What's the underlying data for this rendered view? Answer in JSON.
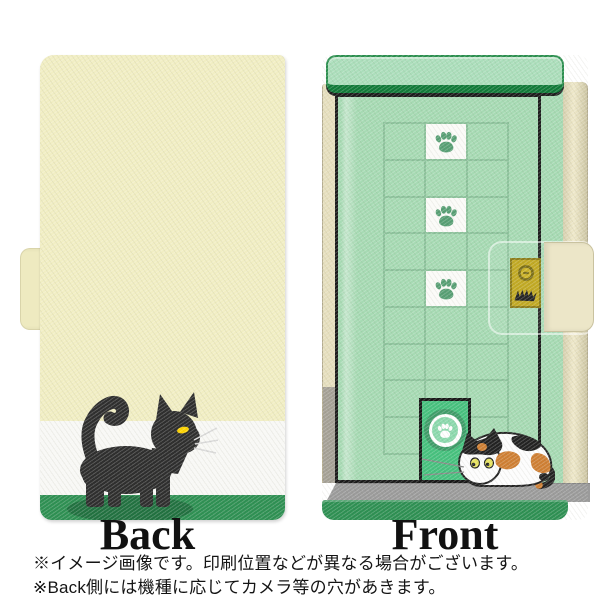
{
  "views": {
    "back": {
      "label": "Back"
    },
    "front": {
      "label": "Front"
    }
  },
  "notes": {
    "line1": "※イメージ画像です。印刷位置などが異なる場合がございます。",
    "line2": "※Back側には機種に応じてカメラ等の穴があきます。"
  },
  "palette": {
    "back_cover_cream": "#f1eec3",
    "band_white": "#f8f8f5",
    "grass_green": "#2e9053",
    "front_door_green": "#a6dab3",
    "lintel_green": "#abdebb",
    "cat_door_green": "#46c17e",
    "lock_plate_gold": "#bda313",
    "floor_gray": "#9b9b9b",
    "spine_beige": "#e9e2c1",
    "black_cat": "#2e2e2e",
    "calico_orange": "#cf7f33",
    "cat_eye_yellow": "#ffd400"
  },
  "icons": {
    "door_tiles": "paw-print-icon",
    "cat_door_window": "paw-print-icon",
    "lock_top": "keyhole-icon",
    "lock_bottom": "cat-scratch-icon"
  }
}
